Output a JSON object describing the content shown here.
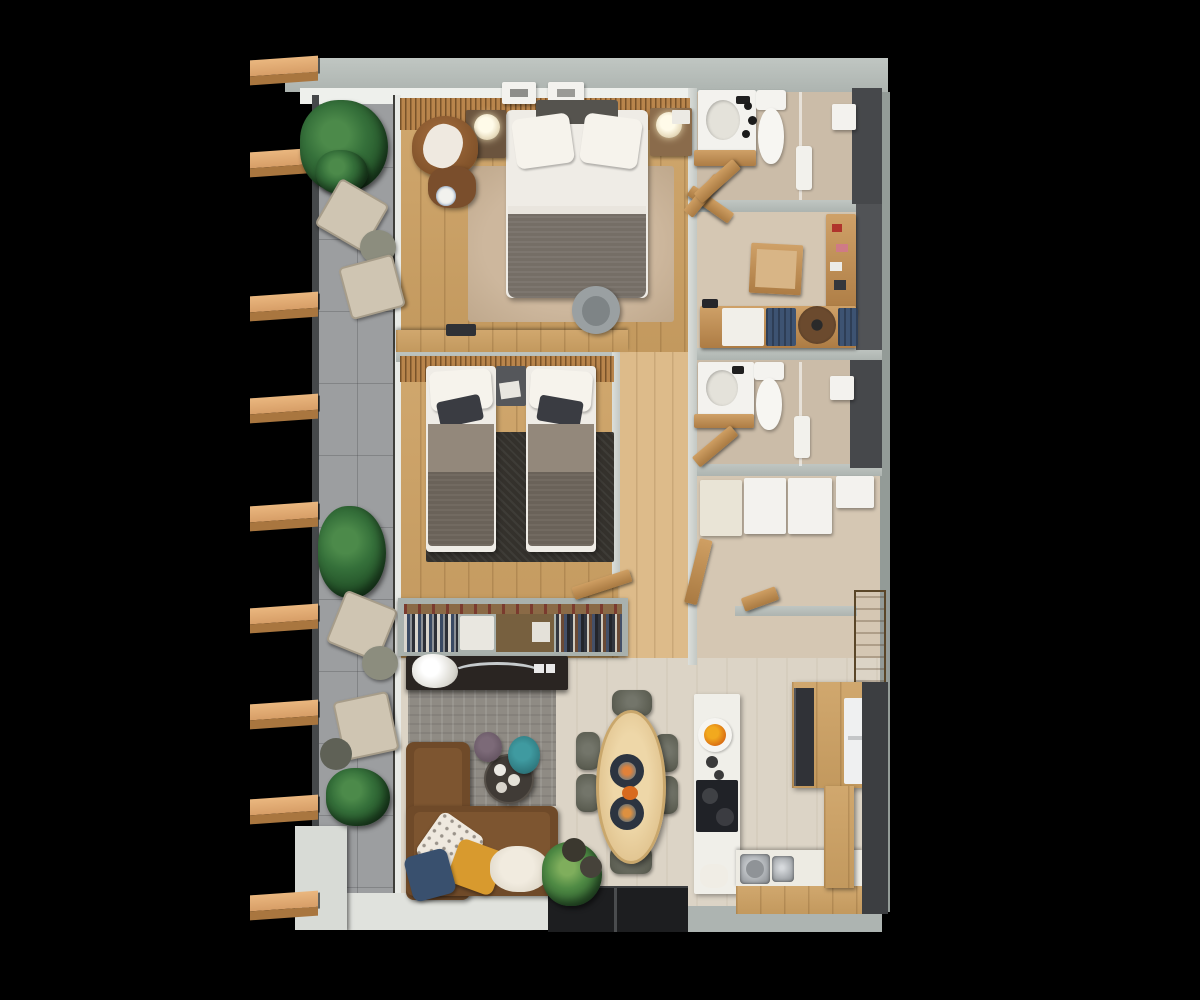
{
  "scene": {
    "description": "3D top-down architectural render of a two-bedroom apartment floor plan on a black background",
    "background": "#000000",
    "palette": {
      "wall_gray_green": "#b5bcb8",
      "dark_shower_wall": "#46484b",
      "wood_floor": "#cda163",
      "light_wood_floor": "#ddbb8a",
      "tan_floor": "#d5c7b3",
      "living_floor": "#dcd4c6",
      "balcony_tile": "#9c9ea0",
      "louver_slat_wood": "#eab77f",
      "sofa_brown": "#6f4a29",
      "blanket_gray": "#756e66",
      "rug_charcoal": "#34312c",
      "rug_gray": "#8f8b84",
      "accent_mustard": "#d89a2e",
      "accent_navy": "#39506e",
      "accent_teal": "#2f7e85",
      "plant_green": "#35703a",
      "counter_white": "#f3f2ee",
      "dining_table_wood": "#e8cd9c",
      "chair_olive": "#5d5f53"
    },
    "balcony": {
      "slat_ys": [
        58,
        150,
        294,
        396,
        504,
        606,
        702,
        797,
        893
      ],
      "furniture": [
        "louver-slats",
        "bush-plants",
        "folding-lounge-chairs",
        "round-side-tables",
        "white-planter"
      ]
    },
    "rooms": [
      {
        "id": "master-bedroom",
        "furniture": [
          "double-bed",
          "pillows",
          "gray-blanket",
          "nightstand-left",
          "nightstand-right",
          "globe-lamps",
          "leather-armchair",
          "ottoman",
          "beige-rug",
          "desk",
          "laptop",
          "desk-chair",
          "slatted-headboard-wall",
          "picture-frames"
        ]
      },
      {
        "id": "bathroom-1",
        "furniture": [
          "vanity-sink",
          "black-faucet",
          "toilet",
          "glass-partition",
          "shower-fixture",
          "towel-rail",
          "wood-door"
        ]
      },
      {
        "id": "dressing-room",
        "furniture": [
          "double-wood-doors",
          "low-wood-table",
          "cosmetics-shelf",
          "bench",
          "white-cabinet",
          "navy-cushions",
          "round-stool"
        ]
      },
      {
        "id": "bedroom-2",
        "furniture": [
          "twin-bed-left",
          "twin-bed-right",
          "shared-nightstand",
          "charcoal-rug",
          "open-wardrobe-with-clothes",
          "wood-door",
          "slatted-headboard-wall"
        ]
      },
      {
        "id": "bathroom-2",
        "furniture": [
          "vanity-sink",
          "toilet",
          "glass-partition",
          "shower-fixture",
          "towel-rail",
          "wood-door"
        ]
      },
      {
        "id": "walk-in-closet",
        "furniture": [
          "wardrobe-unit-cream",
          "wardrobe-unit-white-1",
          "wardrobe-unit-white-2",
          "wardrobe-unit-white-3",
          "wood-door"
        ]
      },
      {
        "id": "entry-hall",
        "furniture": [
          "entry-door",
          "wood-door-leaf"
        ]
      },
      {
        "id": "living-room",
        "furniture": [
          "media-console",
          "white-flowers",
          "l-shaped-sofa",
          "patterned-pillow",
          "mustard-pillow",
          "navy-pillow",
          "cream-throw",
          "round-coffee-table",
          "purple-pouf",
          "teal-pouf",
          "gray-rug",
          "house-plant",
          "dark-pots",
          "sliding-glass-door"
        ]
      },
      {
        "id": "dining-area",
        "furniture": [
          "oval-dining-table",
          "dining-chairs",
          "dinner-plate-1",
          "dinner-plate-2",
          "center-dish"
        ],
        "chair_count": 6
      },
      {
        "id": "kitchen",
        "furniture": [
          "white-counter-run",
          "fruit-plate",
          "cooktop",
          "double-steel-sink",
          "towel",
          "tall-wood-cabinet",
          "fridge",
          "oven-column",
          "wood-counter-column",
          "dark-feature-wall"
        ]
      }
    ]
  }
}
